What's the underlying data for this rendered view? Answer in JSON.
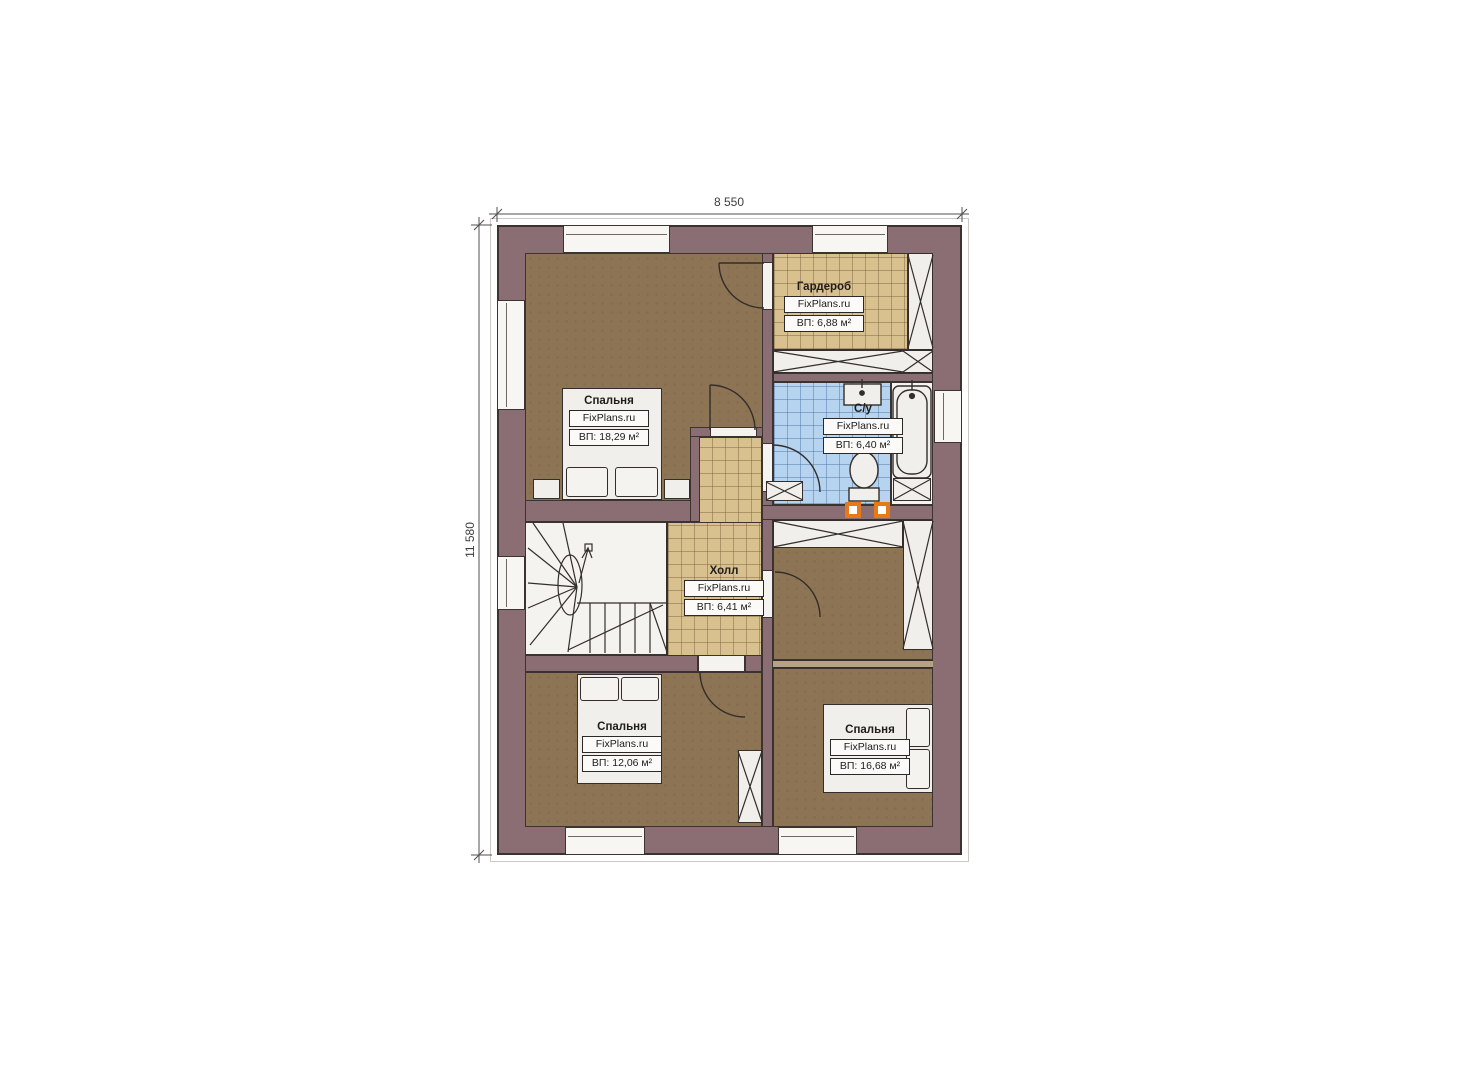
{
  "dims": {
    "width_label": "8 550",
    "height_label": "11 580"
  },
  "rooms": {
    "wardrobe": {
      "name": "Гардероб",
      "brand": "FixPlans.ru",
      "area": "ВП: 6,88 м²"
    },
    "bedroom_top": {
      "name": "Спальня",
      "brand": "FixPlans.ru",
      "area": "ВП: 18,29 м²"
    },
    "bathroom": {
      "name": "С/у",
      "brand": "FixPlans.ru",
      "area": "ВП: 6,40 м²"
    },
    "hall": {
      "name": "Холл",
      "brand": "FixPlans.ru",
      "area": "ВП: 6,41 м²"
    },
    "bedroom_bottom_left": {
      "name": "Спальня",
      "brand": "FixPlans.ru",
      "area": "ВП: 12,06 м²"
    },
    "bedroom_bottom_right": {
      "name": "Спальня",
      "brand": "FixPlans.ru",
      "area": "ВП: 16,68 м²"
    }
  },
  "colors": {
    "wall": "#8a6e73",
    "wood_floor": "#8d7454",
    "tile_tan": "#d9c08f",
    "tile_blue": "#b6d3ef",
    "line": "#332e2b",
    "accent_orange": "#e6791a"
  }
}
